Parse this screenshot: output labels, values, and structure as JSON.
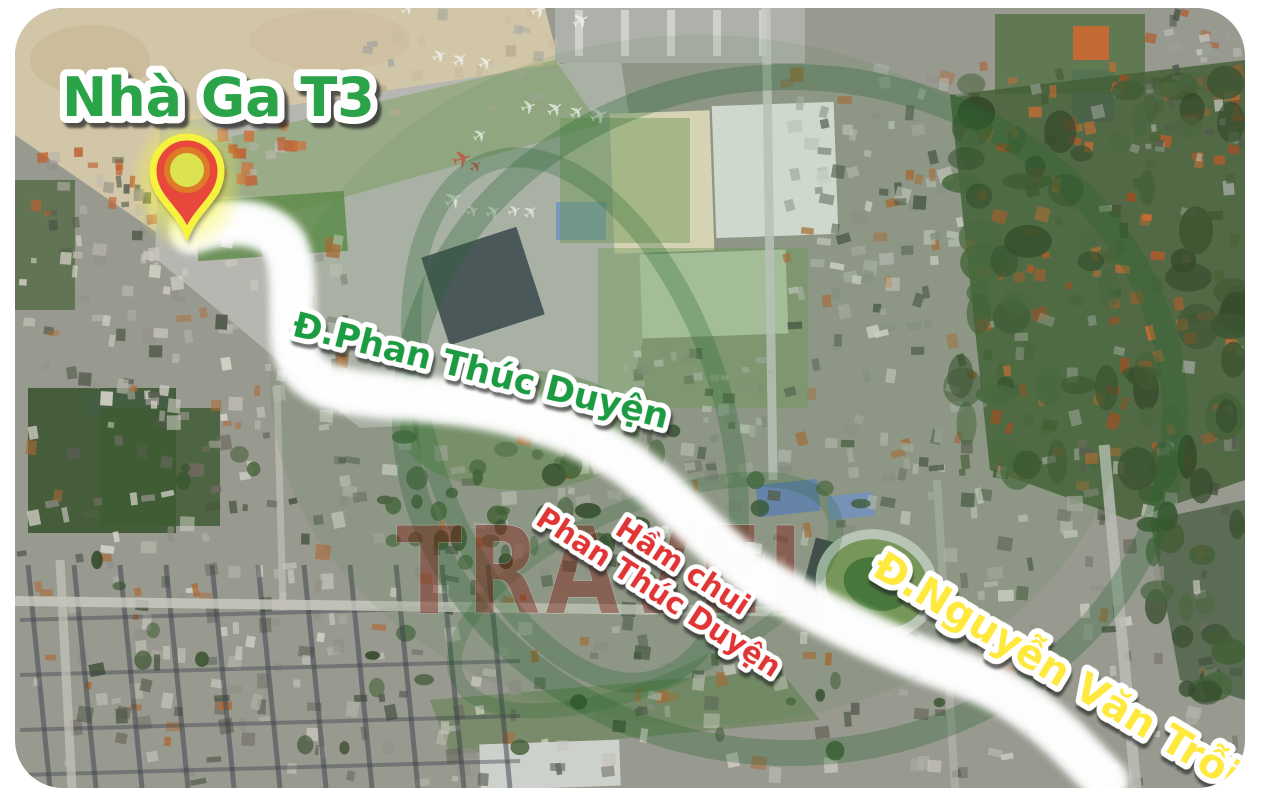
{
  "map_card": {
    "type": "satellite-route-map",
    "corner_radius_px": 48,
    "labels": {
      "terminal": "Nhà Ga T3",
      "road_1": "Đ.Phan Thúc Duyện",
      "tunnel_line1": "Hầm chui",
      "tunnel_line2": "Phan Thúc Duyện",
      "road_2": "Đ.Nguyễn Văn Trỗi",
      "watermark": "TRAVEL"
    },
    "label_colors": {
      "terminal": "#29a348",
      "road_1": "#1f9c42",
      "tunnel": "#e13434",
      "road_2": "#ffe93c",
      "watermark": "#7e1a10"
    },
    "origin_marker": {
      "kind": "location-pin",
      "pin_color": "#e8463a",
      "glow_color": "#f5f33f",
      "inner_ring_color": "#dd7b28",
      "inner_dot_color": "#dbe34e"
    },
    "route": {
      "from": "Nhà Ga T3",
      "roads": [
        "Đ.Phan Thúc Duyện",
        "Đ.Nguyễn Văn Trỗi"
      ],
      "band_color": "#23ab55",
      "stripe_color": "#ffffff"
    },
    "watermark_logo_color": "#2e7d32"
  }
}
